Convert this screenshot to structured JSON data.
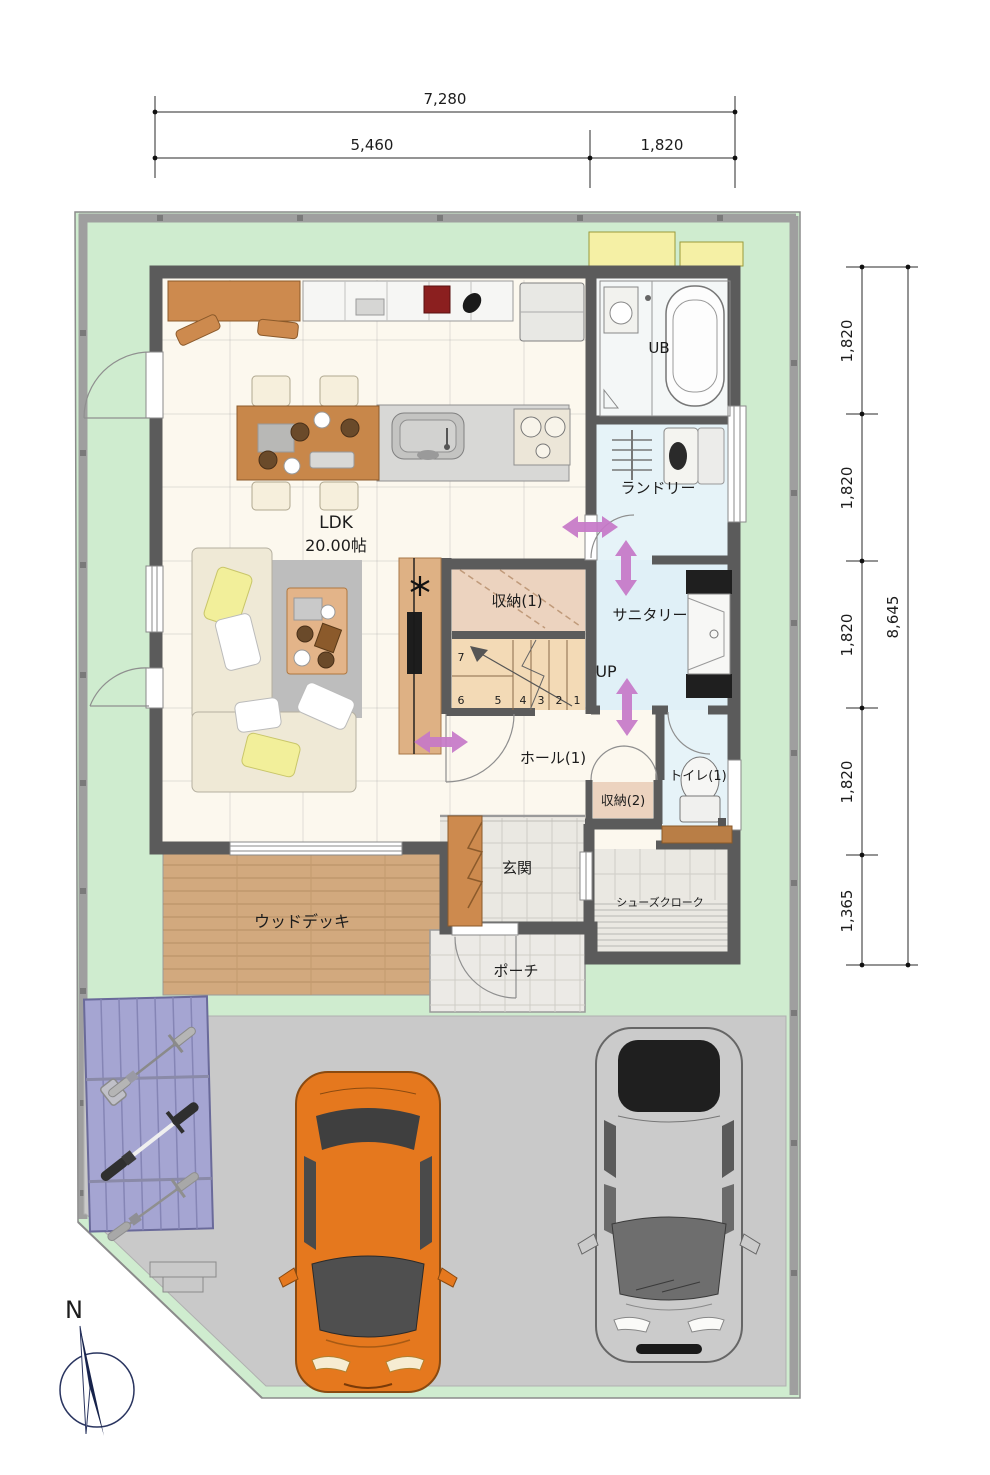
{
  "plan": {
    "type": "first-floor-plan"
  },
  "dimensions": {
    "top": {
      "total": "7,280",
      "seg_left": "5,460",
      "seg_right": "1,820"
    },
    "right": {
      "segments": [
        "1,820",
        "1,820",
        "1,820",
        "1,820",
        "1,365"
      ],
      "total": "8,645"
    }
  },
  "rooms": {
    "ldk_name": "LDK",
    "ldk_size": "20.00帖",
    "unit_bath": "UB",
    "laundry": "ランドリー",
    "sanitary": "サニタリー",
    "storage_1": "収納(1)",
    "storage_2": "収納(2)",
    "hall_1": "ホール(1)",
    "toilet_1": "トイレ(1)",
    "entrance": "玄関",
    "shoe_closet": "シューズクローク",
    "porch": "ポーチ",
    "wood_deck": "ウッドデッキ",
    "stairs_up": "UP"
  },
  "stairs": {
    "steps": [
      "7",
      "6",
      "5",
      "4",
      "3",
      "2",
      "1"
    ]
  },
  "compass": {
    "north": "N"
  },
  "colors": {
    "lawn": "#cfeccf",
    "driveway": "#c9c9c9",
    "wall": "#5b5b5b",
    "flow_arrow": "#c678c8",
    "wood_deck": "#d2a97e",
    "water_floor": "#e6f3f8",
    "storage_floor": "#ecd3bf",
    "stairs_floor": "#f3dab6",
    "car_orange": "#e5781e",
    "car_silver": "#c9c9c9",
    "bike_area": "#a5a5d2",
    "equipment_pad": "#f5f0a5"
  }
}
